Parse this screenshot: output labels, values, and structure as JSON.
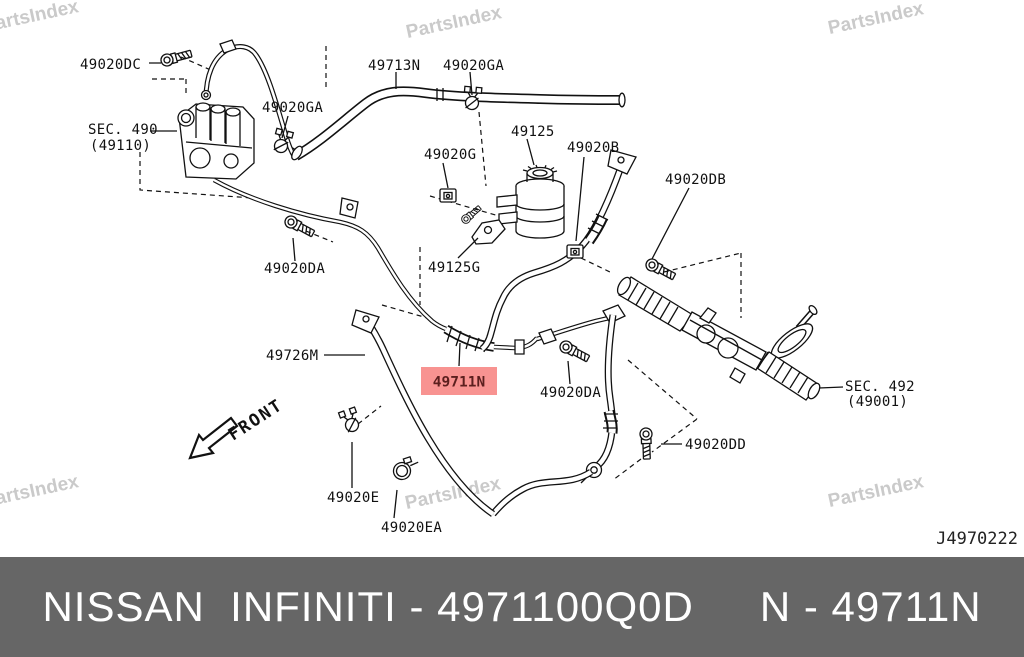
{
  "watermark": {
    "text": "PartsIndex",
    "color": "#cacaca"
  },
  "diagram": {
    "ref_code": "J4970222",
    "front_label": "FRONT",
    "highlight": {
      "text": "49711N",
      "bg": "#f89391",
      "fg": "#5c1f1e"
    },
    "labels": [
      {
        "id": "49020DC",
        "text": "49020DC"
      },
      {
        "id": "SEC490",
        "text": "SEC. 490"
      },
      {
        "id": "SEC490-sub",
        "text": "(49110)"
      },
      {
        "id": "49020GA-left",
        "text": "49020GA"
      },
      {
        "id": "49713N",
        "text": "49713N"
      },
      {
        "id": "49020GA-right",
        "text": "49020GA"
      },
      {
        "id": "49020G",
        "text": "49020G"
      },
      {
        "id": "49125",
        "text": "49125"
      },
      {
        "id": "49020B",
        "text": "49020B"
      },
      {
        "id": "49020DB",
        "text": "49020DB"
      },
      {
        "id": "49020DA-left",
        "text": "49020DA"
      },
      {
        "id": "49125G",
        "text": "49125G"
      },
      {
        "id": "49726M",
        "text": "49726M"
      },
      {
        "id": "49020DA-right",
        "text": "49020DA"
      },
      {
        "id": "SEC492",
        "text": "SEC. 492"
      },
      {
        "id": "SEC492-sub",
        "text": "(49001)"
      },
      {
        "id": "49020DD",
        "text": "49020DD"
      },
      {
        "id": "49020E",
        "text": "49020E"
      },
      {
        "id": "49020EA",
        "text": "49020EA"
      }
    ]
  },
  "banner": {
    "left": "NISSAN  INFINITI - 4971100Q0D",
    "right": "N - 49711N",
    "bg": "#666666",
    "fg": "#ffffff"
  }
}
